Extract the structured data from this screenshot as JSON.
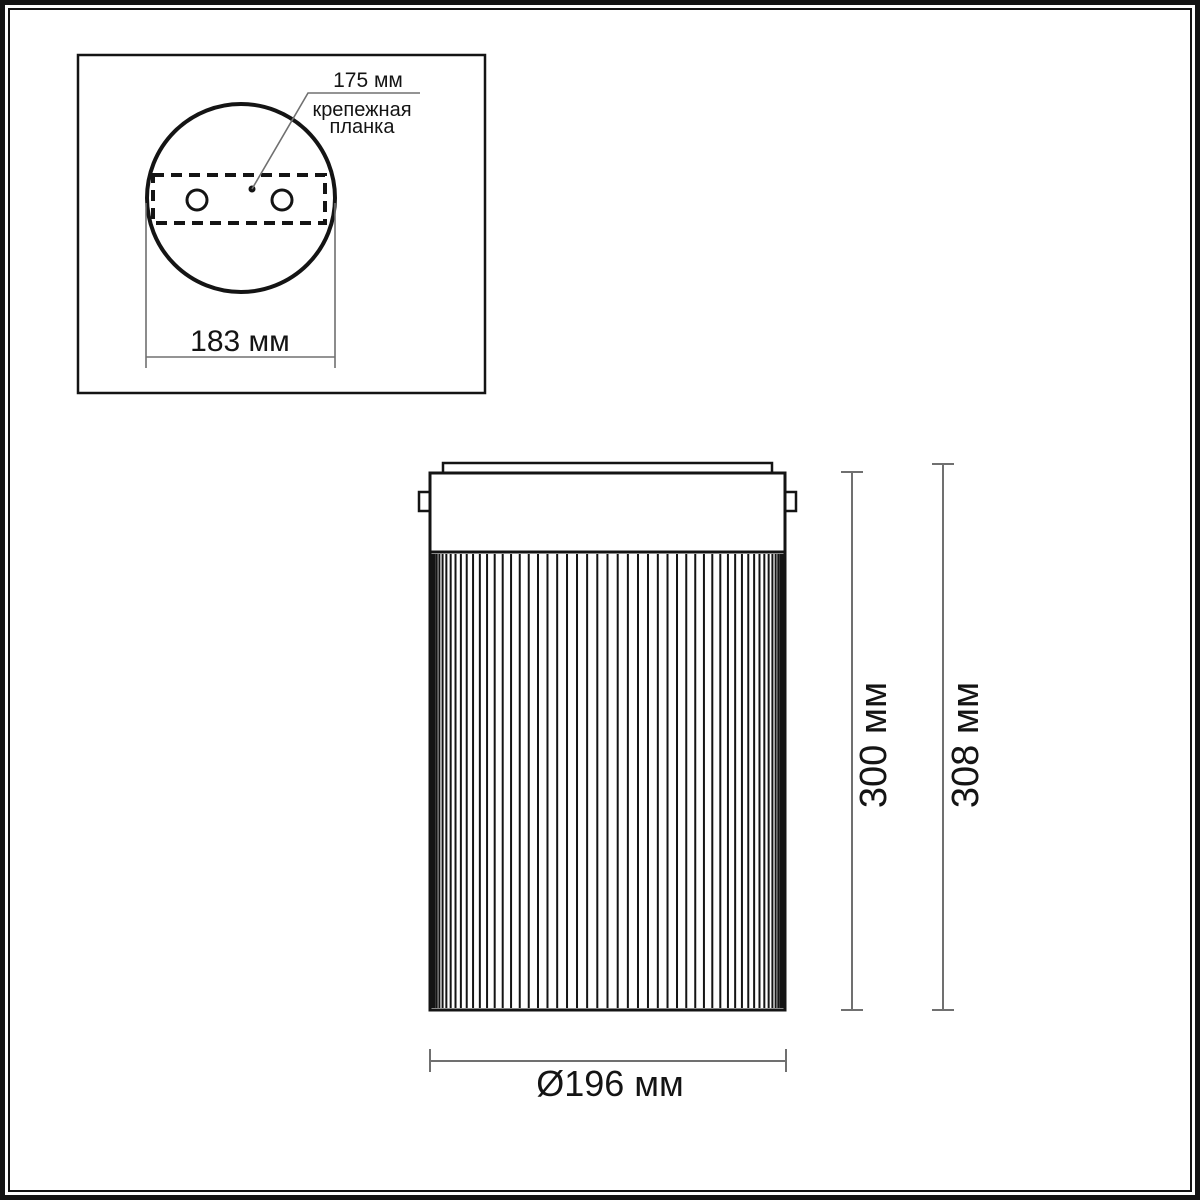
{
  "colors": {
    "ink": "#141414",
    "dimension": "#707070"
  },
  "top_view": {
    "plate_width_label": "175 мм",
    "plate_name_line1": "крепежная",
    "plate_name_line2": "планка",
    "mount_span_label": "183 мм"
  },
  "side_view": {
    "shade_height_label": "300 мм",
    "overall_height_label": "308 мм",
    "diameter_label": "Ø196 мм"
  }
}
